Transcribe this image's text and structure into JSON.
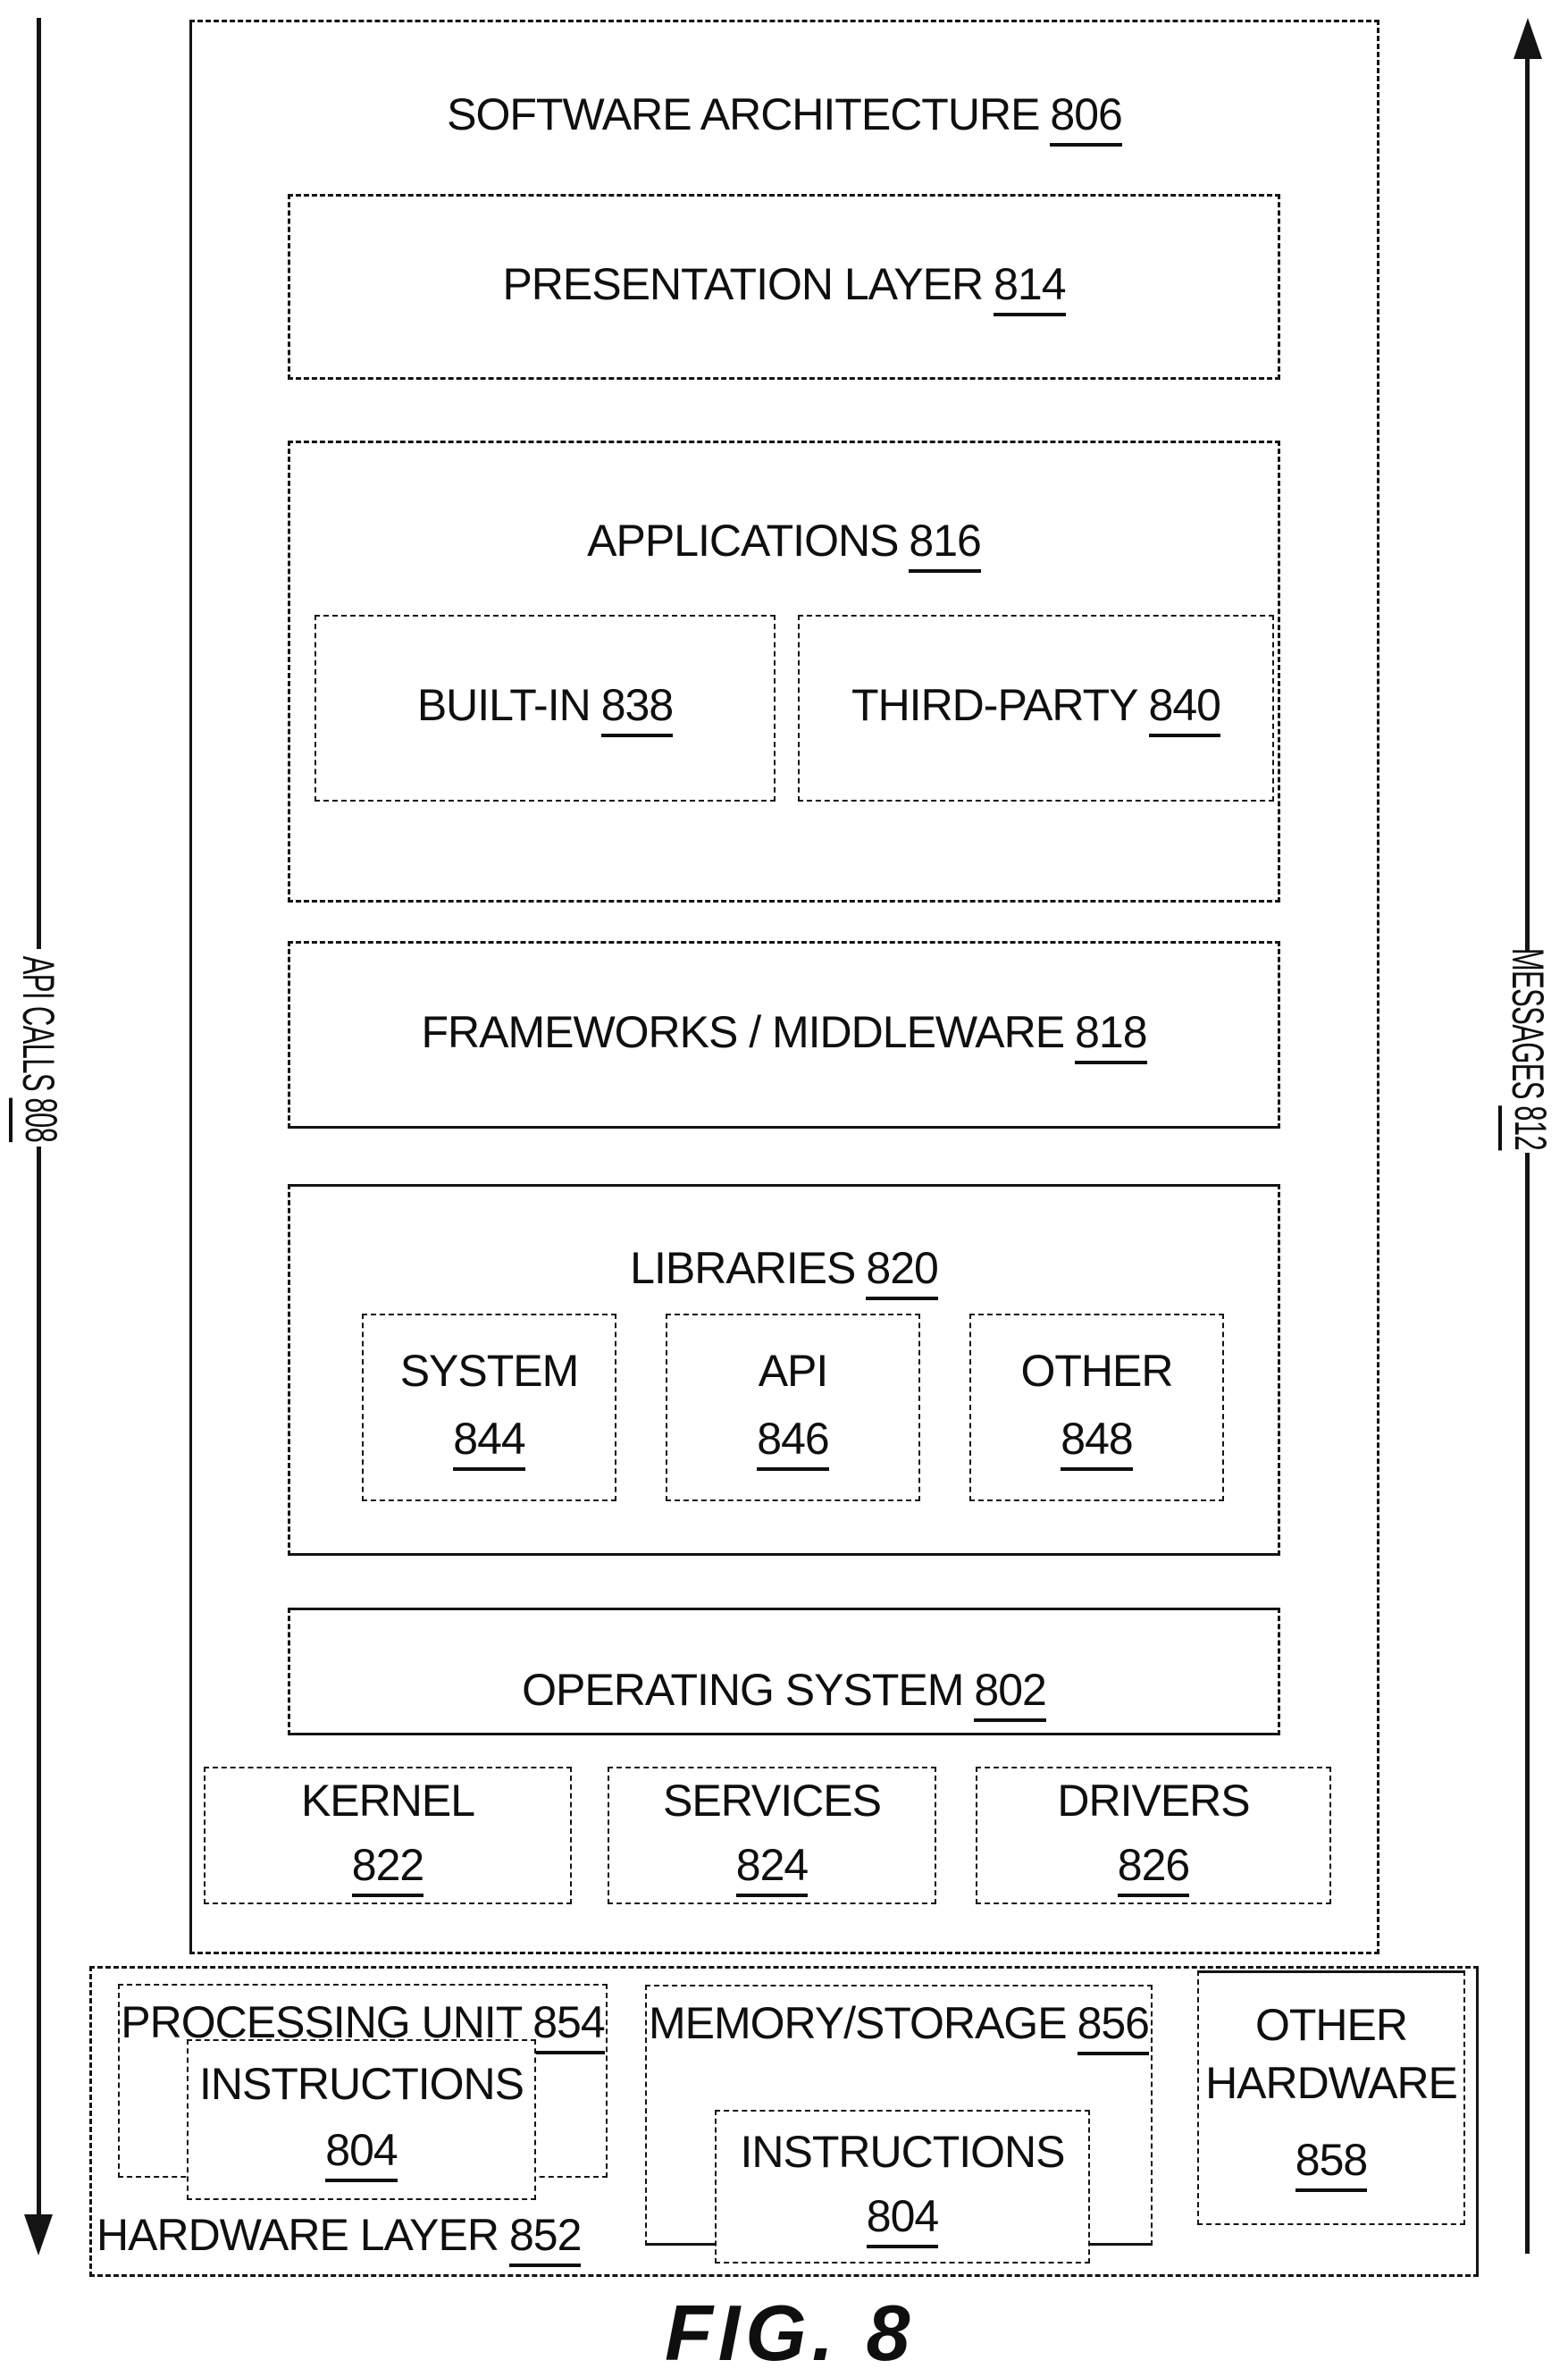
{
  "figure_caption": "FIG. 8",
  "colors": {
    "ink": "#141414",
    "background": "#ffffff"
  },
  "arrows": {
    "api_calls": {
      "label": "API CALLS",
      "ref": "808"
    },
    "messages": {
      "label": "MESSAGES",
      "ref": "812"
    }
  },
  "architecture": {
    "title": {
      "label": "SOFTWARE ARCHITECTURE",
      "ref": "806"
    },
    "presentation": {
      "label": "PRESENTATION LAYER",
      "ref": "814"
    },
    "applications": {
      "title": {
        "label": "APPLICATIONS",
        "ref": "816"
      },
      "built_in": {
        "label": "BUILT-IN",
        "ref": "838"
      },
      "third_party": {
        "label": "THIRD-PARTY",
        "ref": "840"
      }
    },
    "frameworks": {
      "label": "FRAMEWORKS / MIDDLEWARE",
      "ref": "818"
    },
    "libraries": {
      "title": {
        "label": "LIBRARIES",
        "ref": "820"
      },
      "system": {
        "label": "SYSTEM",
        "ref": "844"
      },
      "api": {
        "label": "API",
        "ref": "846"
      },
      "other": {
        "label": "OTHER",
        "ref": "848"
      }
    },
    "operating_system": {
      "label": "OPERATING SYSTEM",
      "ref": "802"
    },
    "kernel": {
      "label": "KERNEL",
      "ref": "822"
    },
    "services": {
      "label": "SERVICES",
      "ref": "824"
    },
    "drivers": {
      "label": "DRIVERS",
      "ref": "826"
    }
  },
  "hardware": {
    "title": {
      "label": "HARDWARE LAYER",
      "ref": "852"
    },
    "processing_unit": {
      "label": "PROCESSING UNIT",
      "ref": "854"
    },
    "pu_instructions": {
      "label": "INSTRUCTIONS",
      "ref": "804"
    },
    "memory": {
      "label": "MEMORY/STORAGE",
      "ref": "856"
    },
    "memory_instructions": {
      "label": "INSTRUCTIONS",
      "ref": "804"
    },
    "other_hardware": {
      "line1": "OTHER",
      "line2": "HARDWARE",
      "ref": "858"
    }
  }
}
